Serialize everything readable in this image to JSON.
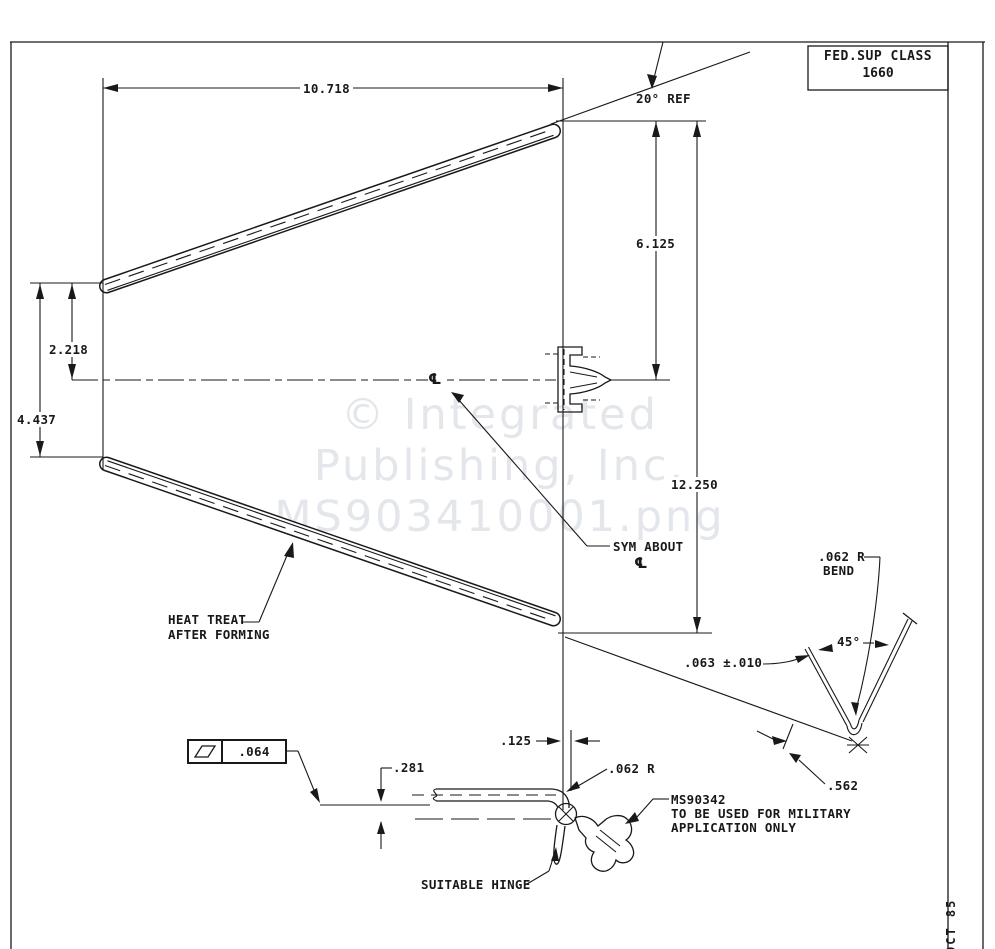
{
  "title_block": {
    "fed_sup_class_label": "FED.SUP CLASS",
    "fed_sup_class_value": "1660"
  },
  "dimensions": {
    "overall_length": "10.718",
    "angle_ref": "20° REF",
    "right_half_height": "6.125",
    "right_opening": "12.250",
    "left_half_height": "2.218",
    "left_opening": "4.437",
    "flange_gap": ".281",
    "edge_offset": ".125",
    "corner_radius": ".062 R",
    "bend_radius_line1": ".062 R",
    "bend_radius_line2": "BEND",
    "bend_angle": "45°",
    "material_thickness": ".063 ±.010",
    "bend_leg_length": ".562",
    "flatness_tolerance": ".064"
  },
  "notes": {
    "sym_about": "SYM ABOUT",
    "centerline_symbol": "℄",
    "heat_treat_line1": "HEAT TREAT",
    "heat_treat_line2": "AFTER FORMING",
    "hinge_spec_line1": "MS90342",
    "hinge_spec_line2": "TO BE USED FOR MILITARY",
    "hinge_spec_line3": "APPLICATION ONLY",
    "suitable_hinge": "SUITABLE HINGE",
    "side_note": "OCT 85"
  },
  "watermark": {
    "line1": "© Integrated",
    "line2": "Publishing, Inc.",
    "line3": "MS903410001.png"
  },
  "colors": {
    "ink": "#191919",
    "paper": "#ffffff",
    "watermark": "#e3e6ea"
  }
}
